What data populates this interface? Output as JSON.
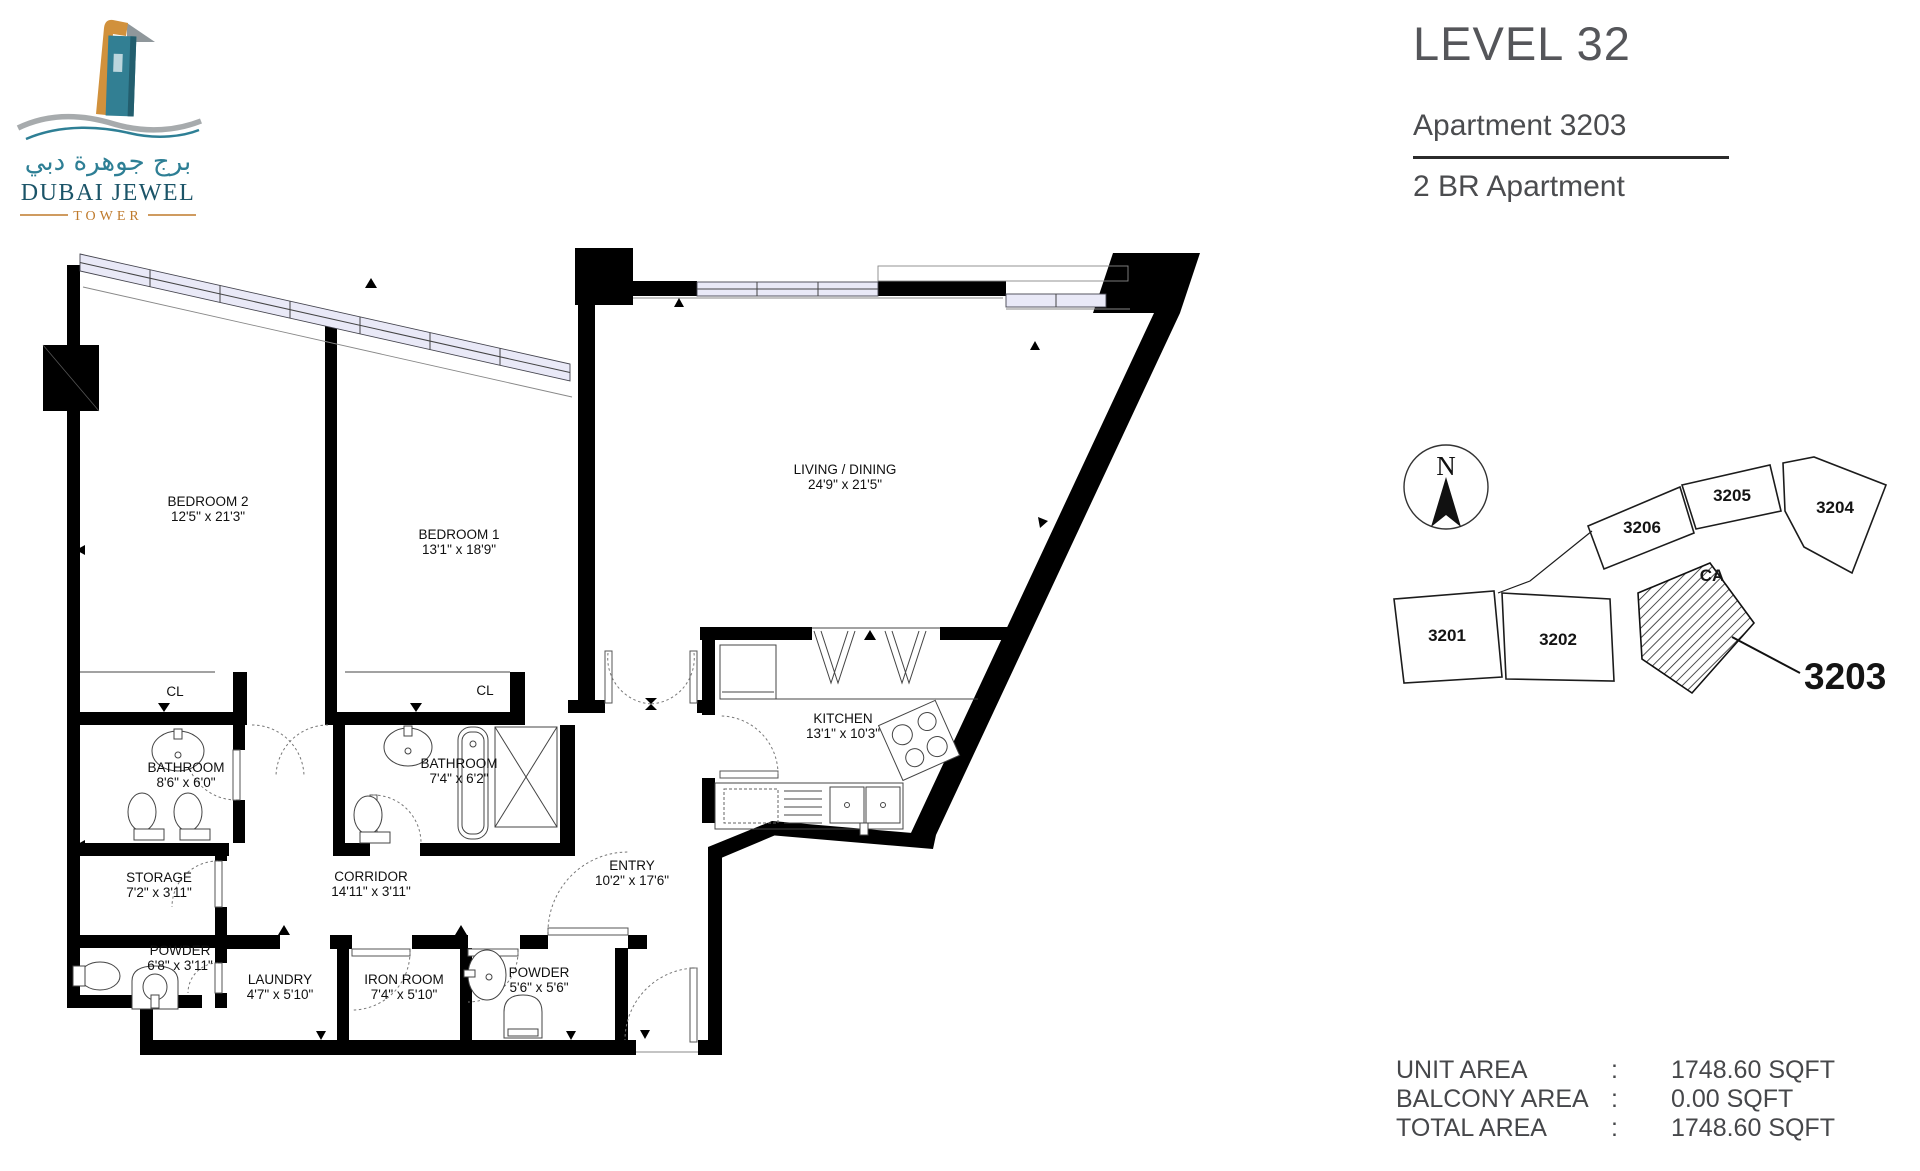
{
  "logo": {
    "arabic": "برج جوهرة دبي",
    "name": "DUBAI JEWEL",
    "subtitle": "TOWER"
  },
  "header": {
    "level": "LEVEL 32",
    "apartment": "Apartment 3203",
    "type": "2 BR Apartment"
  },
  "floor_plan": {
    "rooms": {
      "bedroom2": {
        "name": "BEDROOM 2",
        "dims": "12'5\" x 21'3\""
      },
      "bedroom1": {
        "name": "BEDROOM 1",
        "dims": "13'1\" x 18'9\""
      },
      "living": {
        "name": "LIVING / DINING",
        "dims": "24'9\" x 21'5\""
      },
      "kitchen": {
        "name": "KITCHEN",
        "dims": "13'1\" x 10'3\""
      },
      "closet_left": {
        "name": "CL"
      },
      "closet_right": {
        "name": "CL"
      },
      "bathroom_left": {
        "name": "BATHROOM",
        "dims": "8'6\" x 6'0\""
      },
      "bathroom_right": {
        "name": "BATHROOM",
        "dims": "7'4\" x 6'2\""
      },
      "storage": {
        "name": "STORAGE",
        "dims": "7'2\" x 3'11\""
      },
      "corridor": {
        "name": "CORRIDOR",
        "dims": "14'11\" x 3'11\""
      },
      "entry": {
        "name": "ENTRY",
        "dims": "10'2\" x 17'6\""
      },
      "powder1": {
        "name": "POWDER",
        "dims": "6'8\" x 3'11\""
      },
      "laundry": {
        "name": "LAUNDRY",
        "dims": "4'7\" x 5'10\""
      },
      "iron_room": {
        "name": "IRON ROOM",
        "dims": "7'4\" x 5'10\""
      },
      "powder2": {
        "name": "POWDER",
        "dims": "5'6\" x 5'6\""
      }
    }
  },
  "key_plan": {
    "north_label": "N",
    "units": {
      "u3201": "3201",
      "u3202": "3202",
      "u3204": "3204",
      "u3205": "3205",
      "u3206": "3206"
    },
    "common_area_label": "CA",
    "callout_label": "3203"
  },
  "area_table": {
    "rows": [
      {
        "label": "UNIT AREA",
        "sep": ":",
        "value": "1748.60 SQFT"
      },
      {
        "label": "BALCONY AREA",
        "sep": ":",
        "value": "0.00 SQFT"
      },
      {
        "label": "TOTAL AREA",
        "sep": ":",
        "value": "1748.60 SQFT"
      }
    ]
  },
  "colors": {
    "logo_teal": "#2e7f95",
    "logo_navy": "#1b5468",
    "logo_gold": "#bf7a2c",
    "title_grey": "#55565a",
    "window_fill": "#e9e9f7"
  }
}
